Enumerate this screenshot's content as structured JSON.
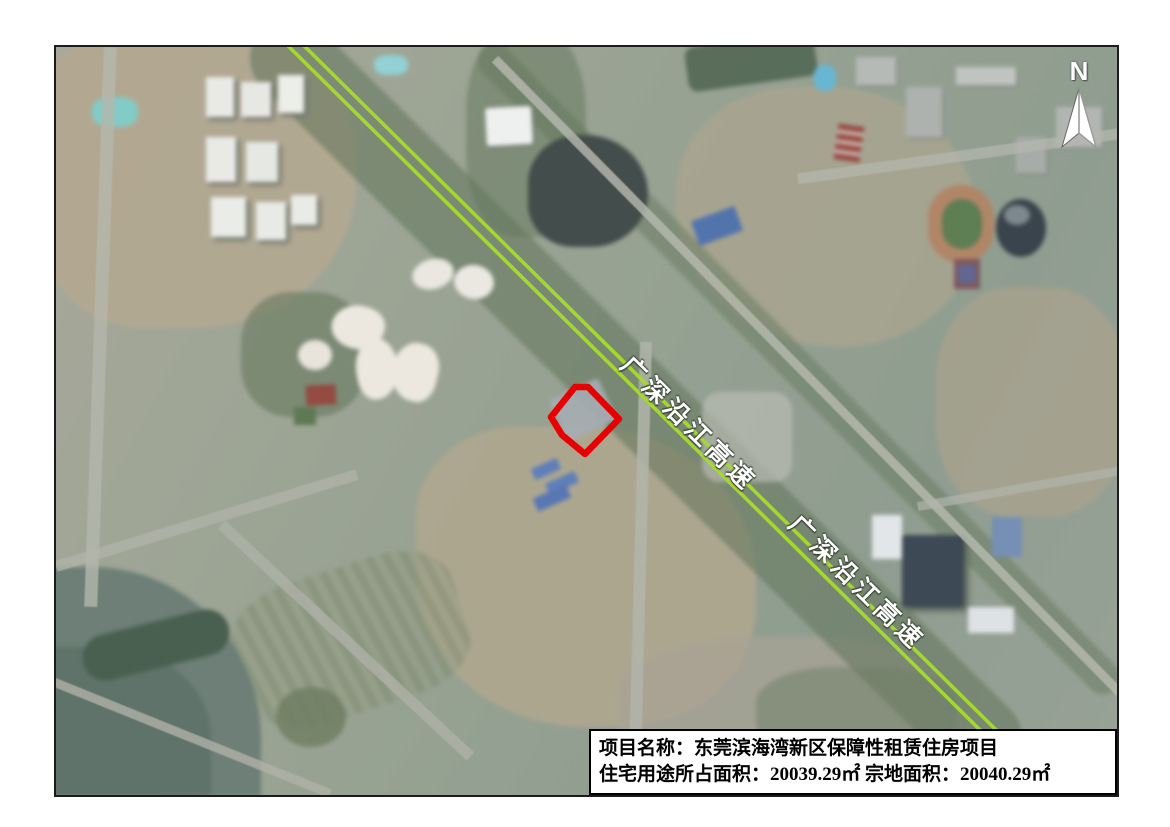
{
  "map": {
    "type": "satellite-annotation-map",
    "north_label": "N",
    "highway": {
      "labels": [
        "广深沿江高速",
        "广深沿江高速"
      ]
    },
    "info_box": {
      "line1": "项目名称：东莞滨海湾新区保障性租赁住房项目",
      "line2": "住宅用途所占面积：20039.29㎡ 宗地面积：20040.29㎡"
    },
    "colors": {
      "highway": "#a4d830",
      "site_outline": "#e60000",
      "label_text": "#ffffff",
      "frame_border": "#1c1c1c"
    }
  }
}
